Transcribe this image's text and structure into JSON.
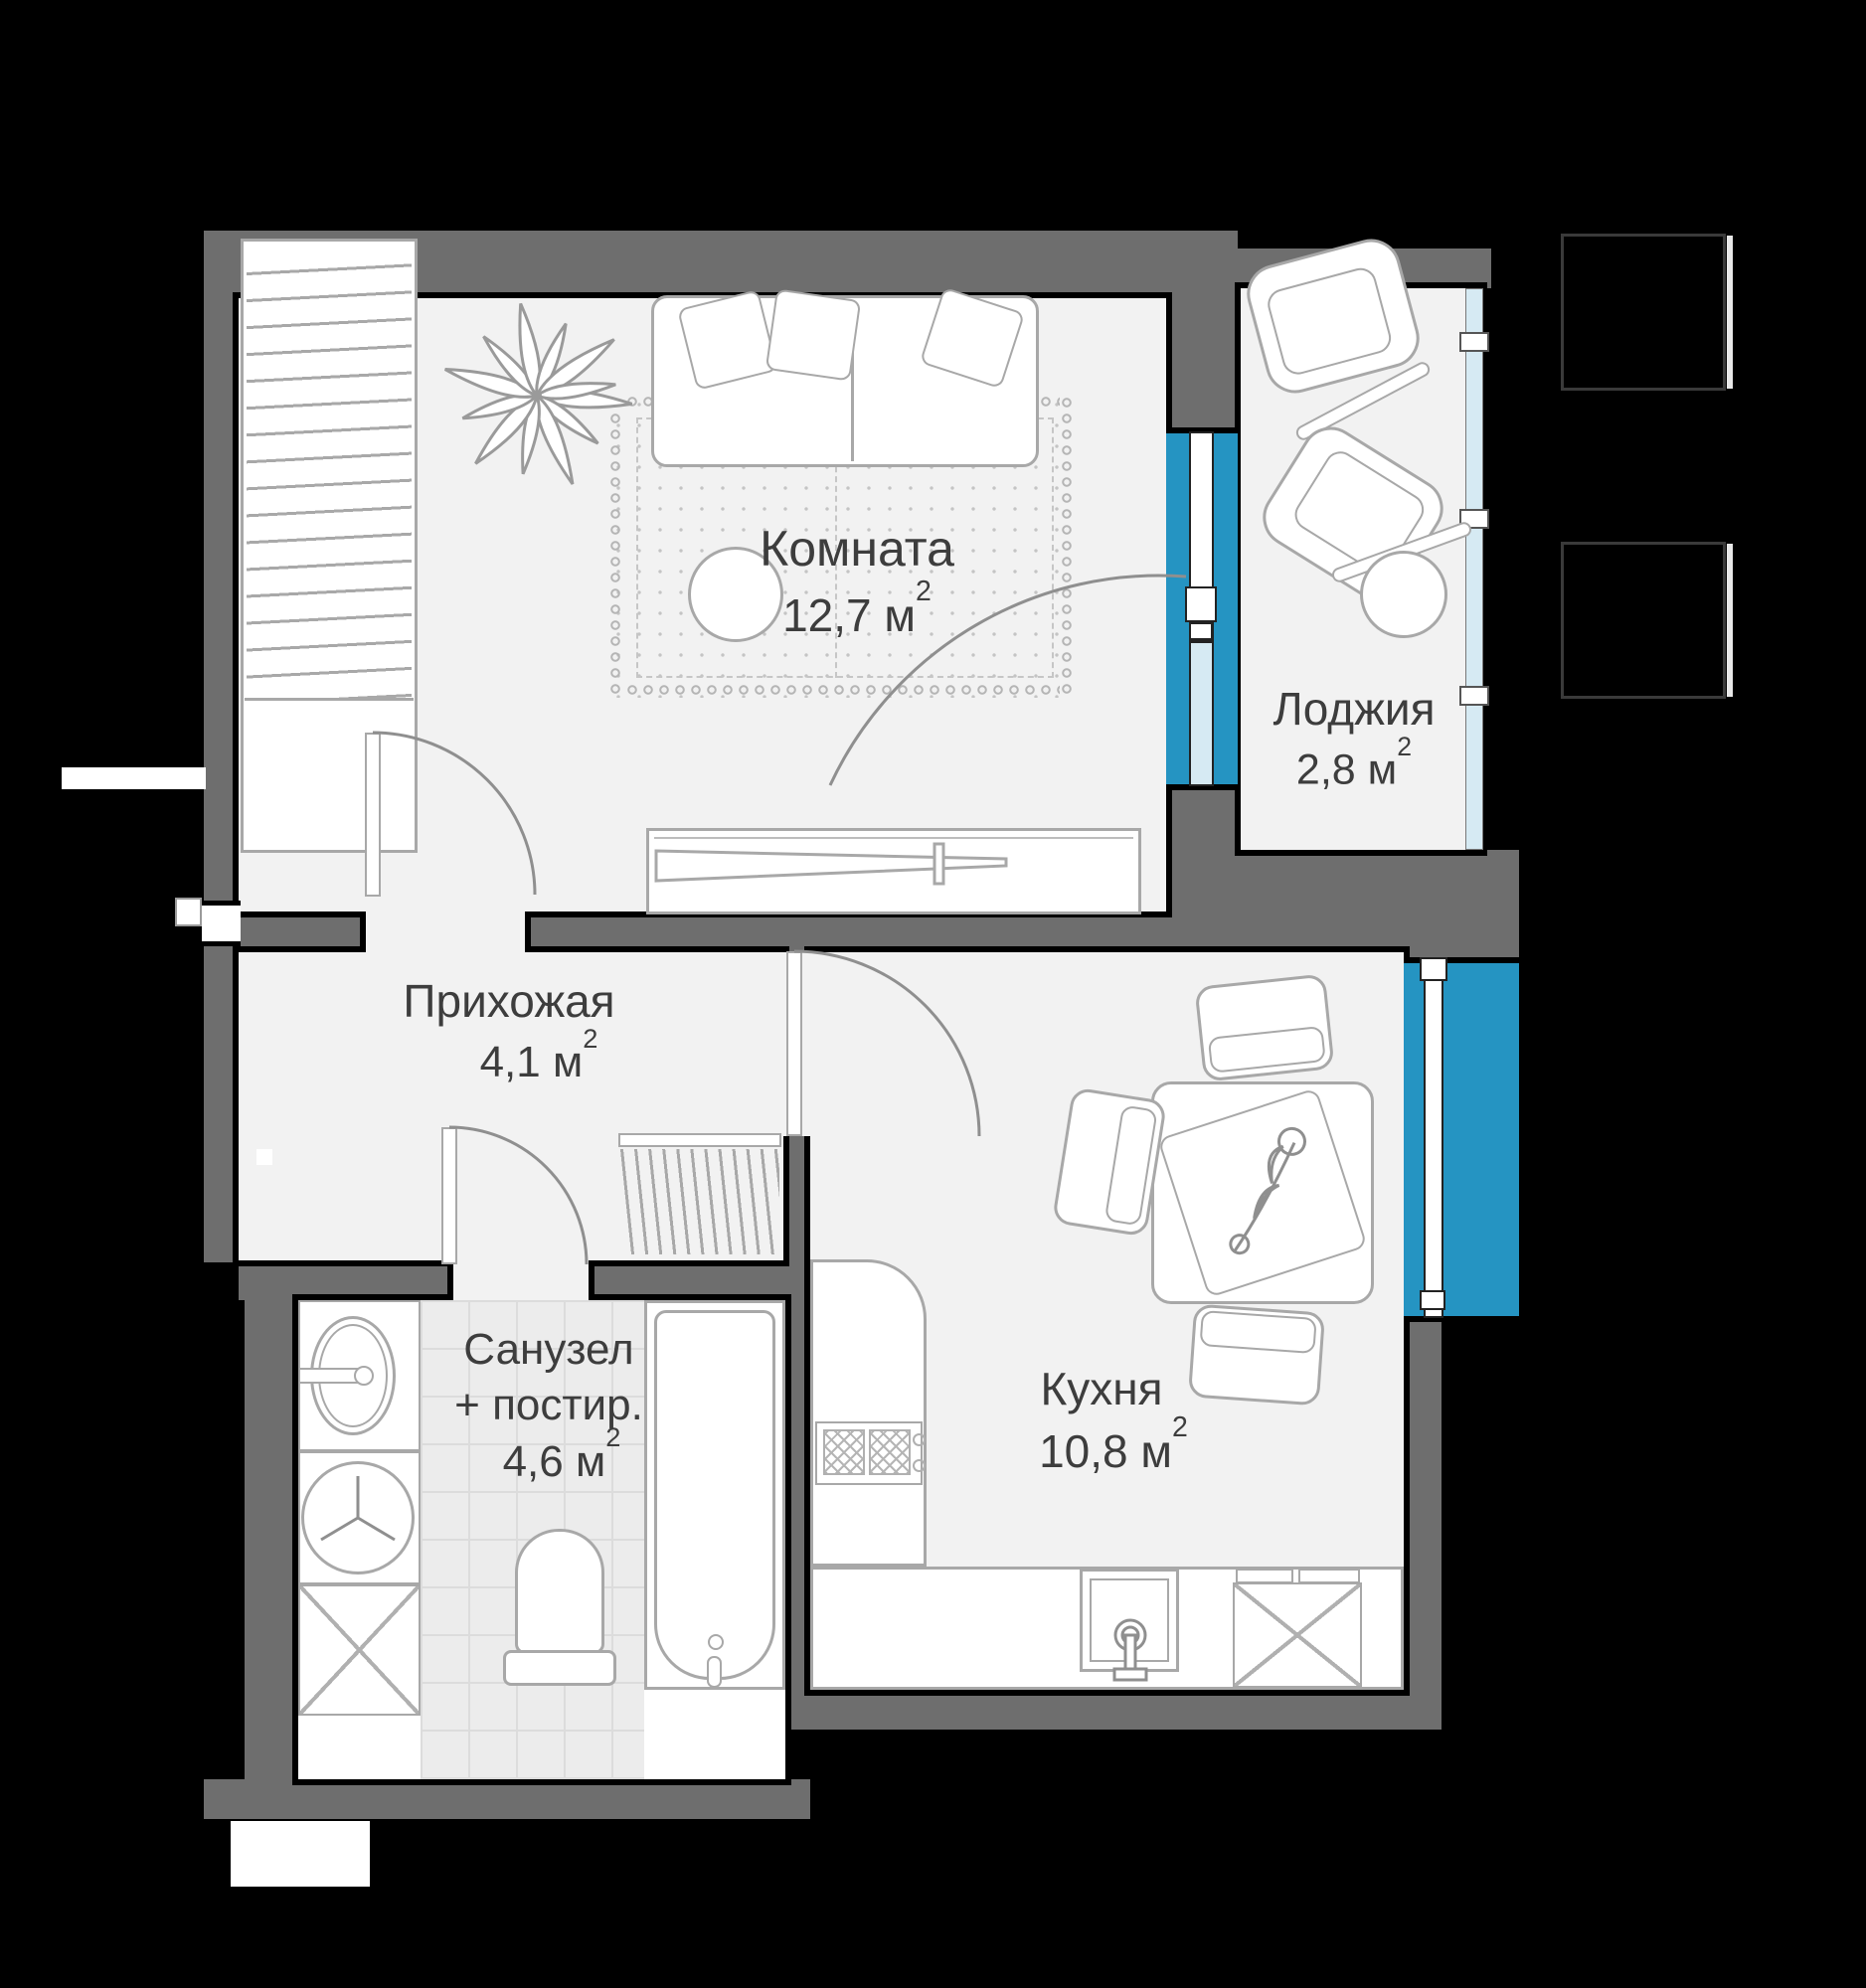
{
  "plan": {
    "colors": {
      "bg": "#000000",
      "wall": "#6e6e6e",
      "floor": "#f2f2f2",
      "tile": "#ececec",
      "tile_line": "#dcdcdc",
      "window": "#2594c2",
      "glass": "#d6eaf3",
      "line": "#a8a8a8",
      "text": "#3d3d3d"
    },
    "rooms": [
      {
        "id": "room",
        "name": "Комната",
        "area": "12,7",
        "unit": "м",
        "sup": "2"
      },
      {
        "id": "loggia",
        "name": "Лоджия",
        "area": "2,8",
        "unit": "м",
        "sup": "2"
      },
      {
        "id": "hallway",
        "name": "Прихожая",
        "area": "4,1",
        "unit": "м",
        "sup": "2"
      },
      {
        "id": "bathroom",
        "name": "Санузел",
        "name2": "+ постир.",
        "area": "4,6",
        "unit": "м",
        "sup": "2"
      },
      {
        "id": "kitchen",
        "name": "Кухня",
        "area": "10,8",
        "unit": "м",
        "sup": "2"
      }
    ]
  }
}
